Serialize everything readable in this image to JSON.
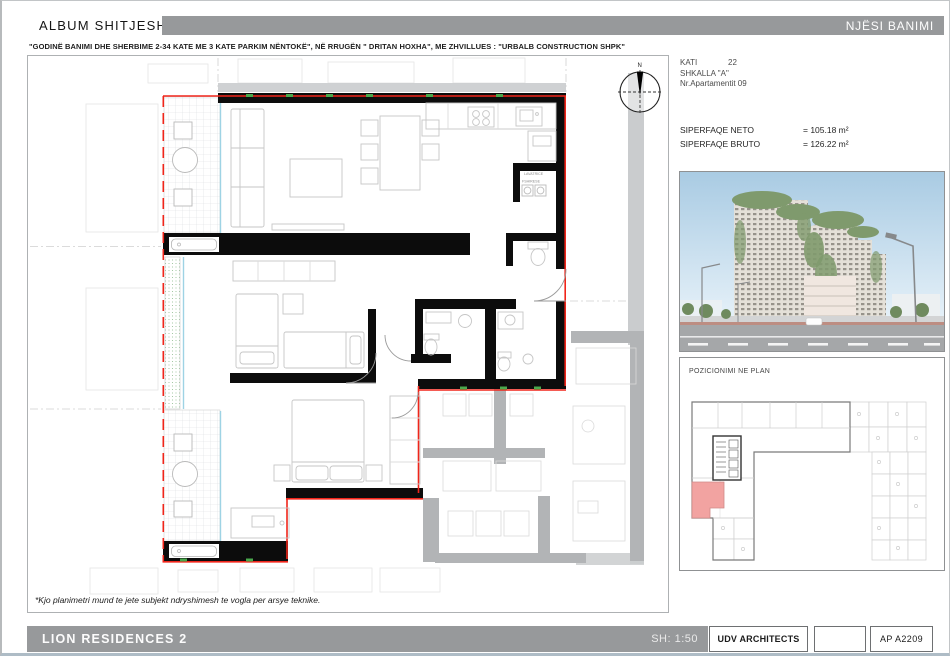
{
  "header": {
    "album_title": "ALBUM SHITJESH",
    "unit_banner": "NJËSI BANIMI",
    "subtitle": "\"GODINË BANIMI DHE SHERBIME 2-34 KATE  ME 3 KATE PARKIM NËNTOKË\", NË RRUGËN \" DRITAN HOXHA\", ME  ZHVILLUES : \"URBALB CONSTRUCTION SHPK\""
  },
  "unit_info": {
    "kati_label": "KATI",
    "kati_value": "22",
    "shkalla": "SHKALLA \"A\"",
    "apartment": "Nr.Apartamentit  09",
    "neto_label": "SIPERFAQE NETO",
    "neto_value": "= 105.18 m²",
    "bruto_label": "SIPERFAQE BRUTO",
    "bruto_value": "= 126.22 m²"
  },
  "plan": {
    "label_lavatrice": "LAVATRICE",
    "label_fshirese": "FSHIRESE",
    "north": "N",
    "footnote": "*Kjo planimetri mund te jete subjekt ndryshimesh te vogla per arsye teknike.",
    "colors": {
      "boundary_red": "#f0251a",
      "wall_black": "#0c0c0c",
      "window_blue": "#9ed3e4",
      "vent_green": "#49a84c",
      "adjacent_gray": "#b2b4b6",
      "slab_gray": "#caccce"
    }
  },
  "keyplan": {
    "title": "POZICIONIMI NE PLAN",
    "highlight_color": "#f2a3a1"
  },
  "footer": {
    "project": "LION  RESIDENCES 2",
    "scale": "SH: 1:50",
    "architects": "UDV ARCHITECTS",
    "sheet": "AP  A2209"
  },
  "theme": {
    "bar_gray": "#97999b"
  }
}
